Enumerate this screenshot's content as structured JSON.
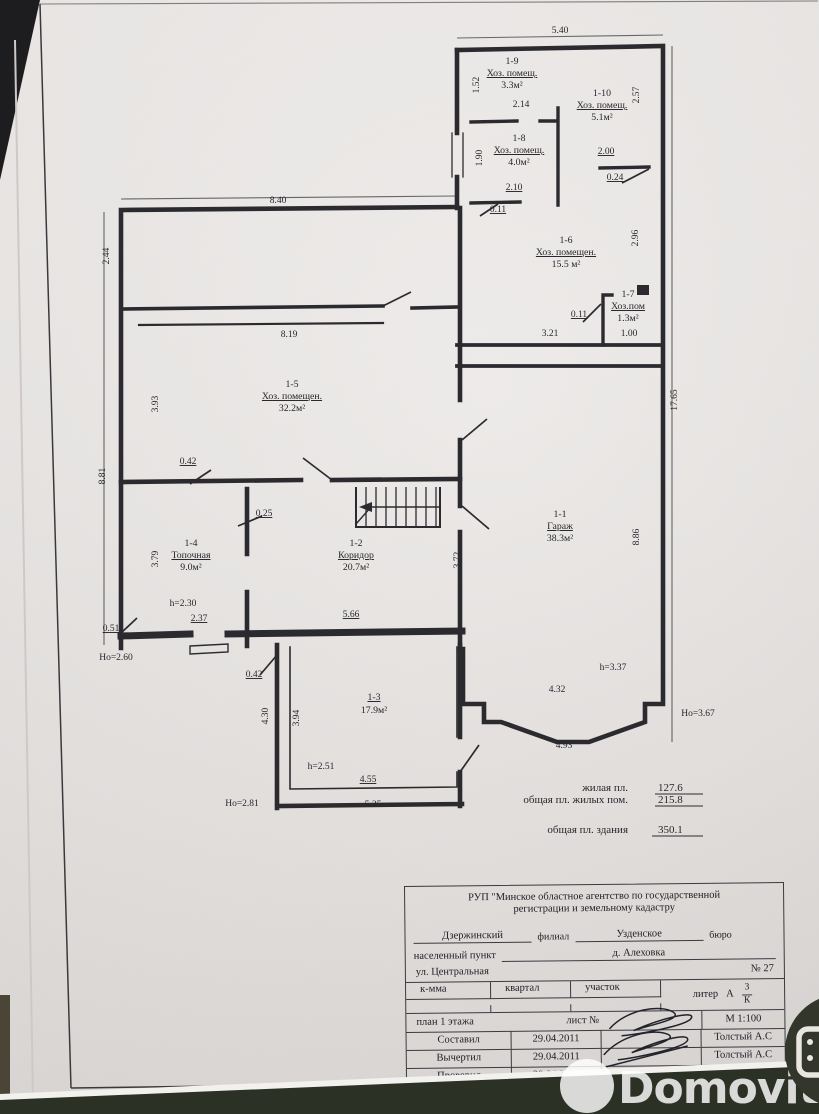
{
  "photo": {
    "paper_color": "#e9e6e4",
    "line_color": "#2b2b2f",
    "background_bottom_color": "#2c3126"
  },
  "plan": {
    "room_labels": [
      {
        "id": "1-9",
        "name": "Хоз. помещ.",
        "area": "3.3м²",
        "x": 512,
        "y": 64
      },
      {
        "id": "1-10",
        "name": "Хоз. помещ.",
        "area": "5.1м²",
        "x": 602,
        "y": 96
      },
      {
        "id": "1-8",
        "name": "Хоз. помещ.",
        "area": "4.0м²",
        "x": 519,
        "y": 141
      },
      {
        "id": "1-6",
        "name": "Хоз. помещен.",
        "area": "15.5 м²",
        "x": 566,
        "y": 243
      },
      {
        "id": "1-7",
        "name": "Хоз.пом",
        "area": "1.3м²",
        "x": 628,
        "y": 297
      },
      {
        "id": "1-5",
        "name": "Хоз. помещен.",
        "area": "32.2м²",
        "x": 292,
        "y": 387
      },
      {
        "id": "1-1",
        "name": "Гараж",
        "area": "38.3м²",
        "x": 560,
        "y": 517
      },
      {
        "id": "1-4",
        "name": "Топочная",
        "area": "9.0м²",
        "x": 191,
        "y": 546
      },
      {
        "id": "1-2",
        "name": "Коридор",
        "area": "20.7м²",
        "x": 356,
        "y": 546
      },
      {
        "id": "1-3",
        "name": "",
        "area": "17.9м²",
        "x": 374,
        "y": 700
      }
    ],
    "dimensions": [
      {
        "text": "5.40",
        "x": 560,
        "y": 33
      },
      {
        "text": "1.52",
        "x": 479,
        "y": 85,
        "rot": -90
      },
      {
        "text": "2.14",
        "x": 521,
        "y": 107
      },
      {
        "text": "2.57",
        "x": 639,
        "y": 95,
        "rot": -90
      },
      {
        "text": "1.90",
        "x": 482,
        "y": 158,
        "rot": -90
      },
      {
        "text": "2.00",
        "x": 606,
        "y": 154,
        "u": true
      },
      {
        "text": "0.24",
        "x": 615,
        "y": 180,
        "u": true
      },
      {
        "text": "2.10",
        "x": 514,
        "y": 190,
        "u": true
      },
      {
        "text": "0.11",
        "x": 498,
        "y": 212,
        "u": true
      },
      {
        "text": "2.96",
        "x": 638,
        "y": 238,
        "rot": -90
      },
      {
        "text": "0.11",
        "x": 579,
        "y": 317,
        "u": true
      },
      {
        "text": "3.21",
        "x": 550,
        "y": 336
      },
      {
        "text": "1.00",
        "x": 629,
        "y": 336
      },
      {
        "text": "17.65",
        "x": 677,
        "y": 400,
        "rot": -90
      },
      {
        "text": "8.40",
        "x": 278,
        "y": 203
      },
      {
        "text": "2.44",
        "x": 109,
        "y": 256,
        "rot": -90
      },
      {
        "text": "8.19",
        "x": 289,
        "y": 337
      },
      {
        "text": "3.93",
        "x": 158,
        "y": 404,
        "rot": -90
      },
      {
        "text": "8.81",
        "x": 105,
        "y": 476,
        "rot": -90
      },
      {
        "text": "0.42",
        "x": 188,
        "y": 464,
        "u": true
      },
      {
        "text": "0.25",
        "x": 264,
        "y": 516,
        "u": true
      },
      {
        "text": "3.79",
        "x": 158,
        "y": 559,
        "rot": -90
      },
      {
        "text": "3.72",
        "x": 460,
        "y": 560,
        "rot": -90
      },
      {
        "text": "h=2.30",
        "x": 183,
        "y": 606
      },
      {
        "text": "2.37",
        "x": 199,
        "y": 621,
        "u": true
      },
      {
        "text": "5.66",
        "x": 351,
        "y": 617,
        "u": true
      },
      {
        "text": "0.51",
        "x": 111,
        "y": 631,
        "u": true
      },
      {
        "text": "Но=2.60",
        "x": 116,
        "y": 660
      },
      {
        "text": "0.42",
        "x": 254,
        "y": 677,
        "u": true
      },
      {
        "text": "4.30",
        "x": 268,
        "y": 716,
        "rot": -90
      },
      {
        "text": "3.94",
        "x": 299,
        "y": 718,
        "rot": -90
      },
      {
        "text": "h=2.51",
        "x": 321,
        "y": 769
      },
      {
        "text": "4.55",
        "x": 368,
        "y": 782,
        "u": true
      },
      {
        "text": "5.25",
        "x": 373,
        "y": 807
      },
      {
        "text": "Но=2.81",
        "x": 242,
        "y": 806
      },
      {
        "text": "8.86",
        "x": 639,
        "y": 537,
        "rot": -90
      },
      {
        "text": "h=3.37",
        "x": 613,
        "y": 670
      },
      {
        "text": "4.32",
        "x": 557,
        "y": 692
      },
      {
        "text": "Но=3.67",
        "x": 698,
        "y": 716
      },
      {
        "text": "4.93",
        "x": 564,
        "y": 748
      }
    ],
    "totals": [
      {
        "label": "жилая пл.",
        "value": "127.6"
      },
      {
        "label": "общая пл. жилых пом.",
        "value": "215.8"
      },
      {
        "label": "общая пл. здания",
        "value": "350.1"
      }
    ]
  },
  "title_block": {
    "agency_line1": "РУП \"Минское областное агентство по государственной",
    "agency_line2": "регистрации и земельному кадастру",
    "branch_name": "Дзержинский",
    "branch_word": "филиал",
    "bureau_name": "Узденское",
    "bureau_word": "бюро",
    "settlement_label": "населенный пункт",
    "settlement_value": "д. Алеховка",
    "street": "ул. Центральная",
    "house_no": "№ 27",
    "col_kmma": "к-мма",
    "col_kvartal": "квартал",
    "col_uchastok": "участок",
    "liter_label": "литер",
    "liter_value": "А",
    "liter_num": "3",
    "liter_den": "К",
    "plan_label": "план 1 этажа",
    "sheet_label": "лист №",
    "scale": "М 1:100",
    "rows": [
      {
        "role": "Составил",
        "date": "29.04.2011",
        "name": "Толстый А.С"
      },
      {
        "role": "Вычертил",
        "date": "29.04.2011",
        "name": "Толстый А.С"
      },
      {
        "role": "Проверил",
        "date": "29.04.2011",
        "name": "Тумилович Н.П"
      }
    ]
  },
  "watermark": {
    "brand": "Domovita"
  }
}
